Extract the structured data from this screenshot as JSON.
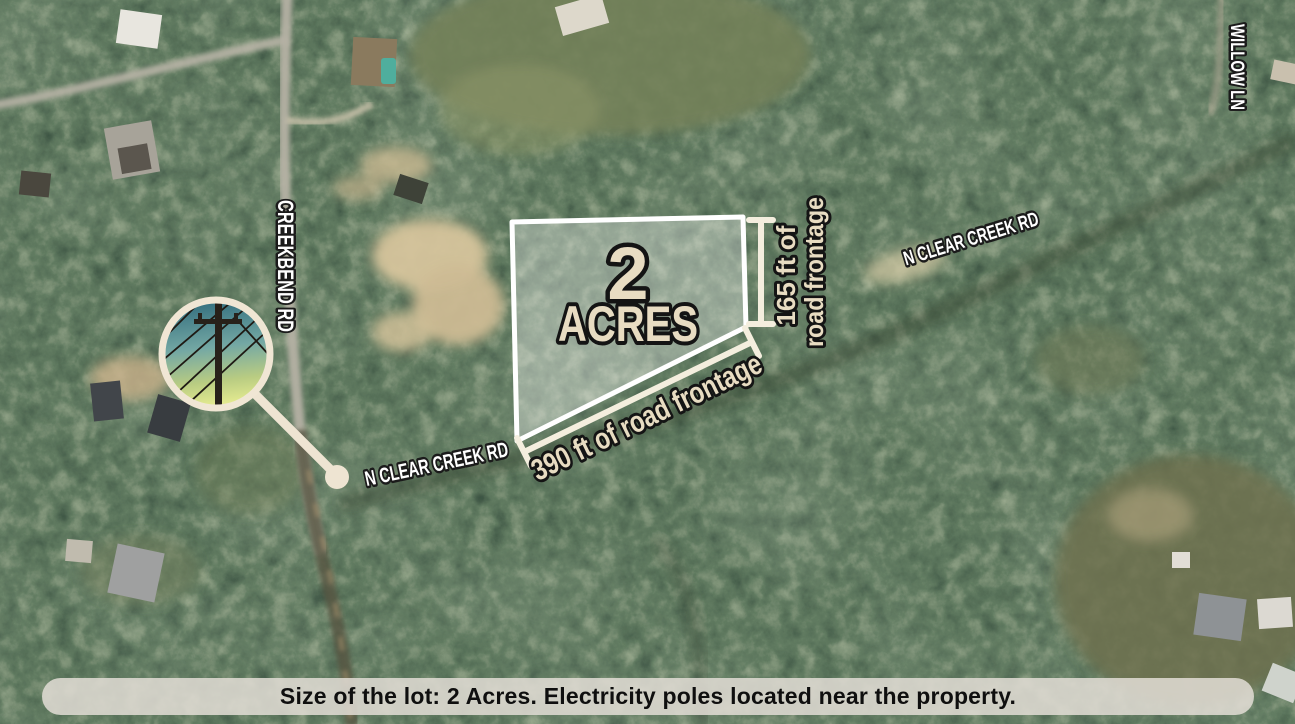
{
  "map": {
    "roads": {
      "creekbend": "CREEKBEND RD",
      "willow": "WILLOW LN",
      "clear_creek": "N CLEAR CREEK RD"
    }
  },
  "lot": {
    "acreage_number": "2",
    "acreage_word": "ACRES",
    "frontage_right_line1": "165 ft of",
    "frontage_right_line2": "road frontage",
    "frontage_bottom": "390 ft of road frontage"
  },
  "inset": {
    "subject": "electricity-poles-photo"
  },
  "caption": {
    "text": "Size of the lot: 2 Acres. Electricity poles located near the property."
  },
  "colors": {
    "annotation_cream": "#e8dcc2",
    "dimension_line": "#f4eede",
    "road_label_white": "#ffffff",
    "lot_stroke": "#ffffff",
    "lot_fill": "rgba(255,255,255,0.34)",
    "caption_bg": "rgba(224,219,211,0.87)",
    "caption_text": "#0f0f0f"
  }
}
